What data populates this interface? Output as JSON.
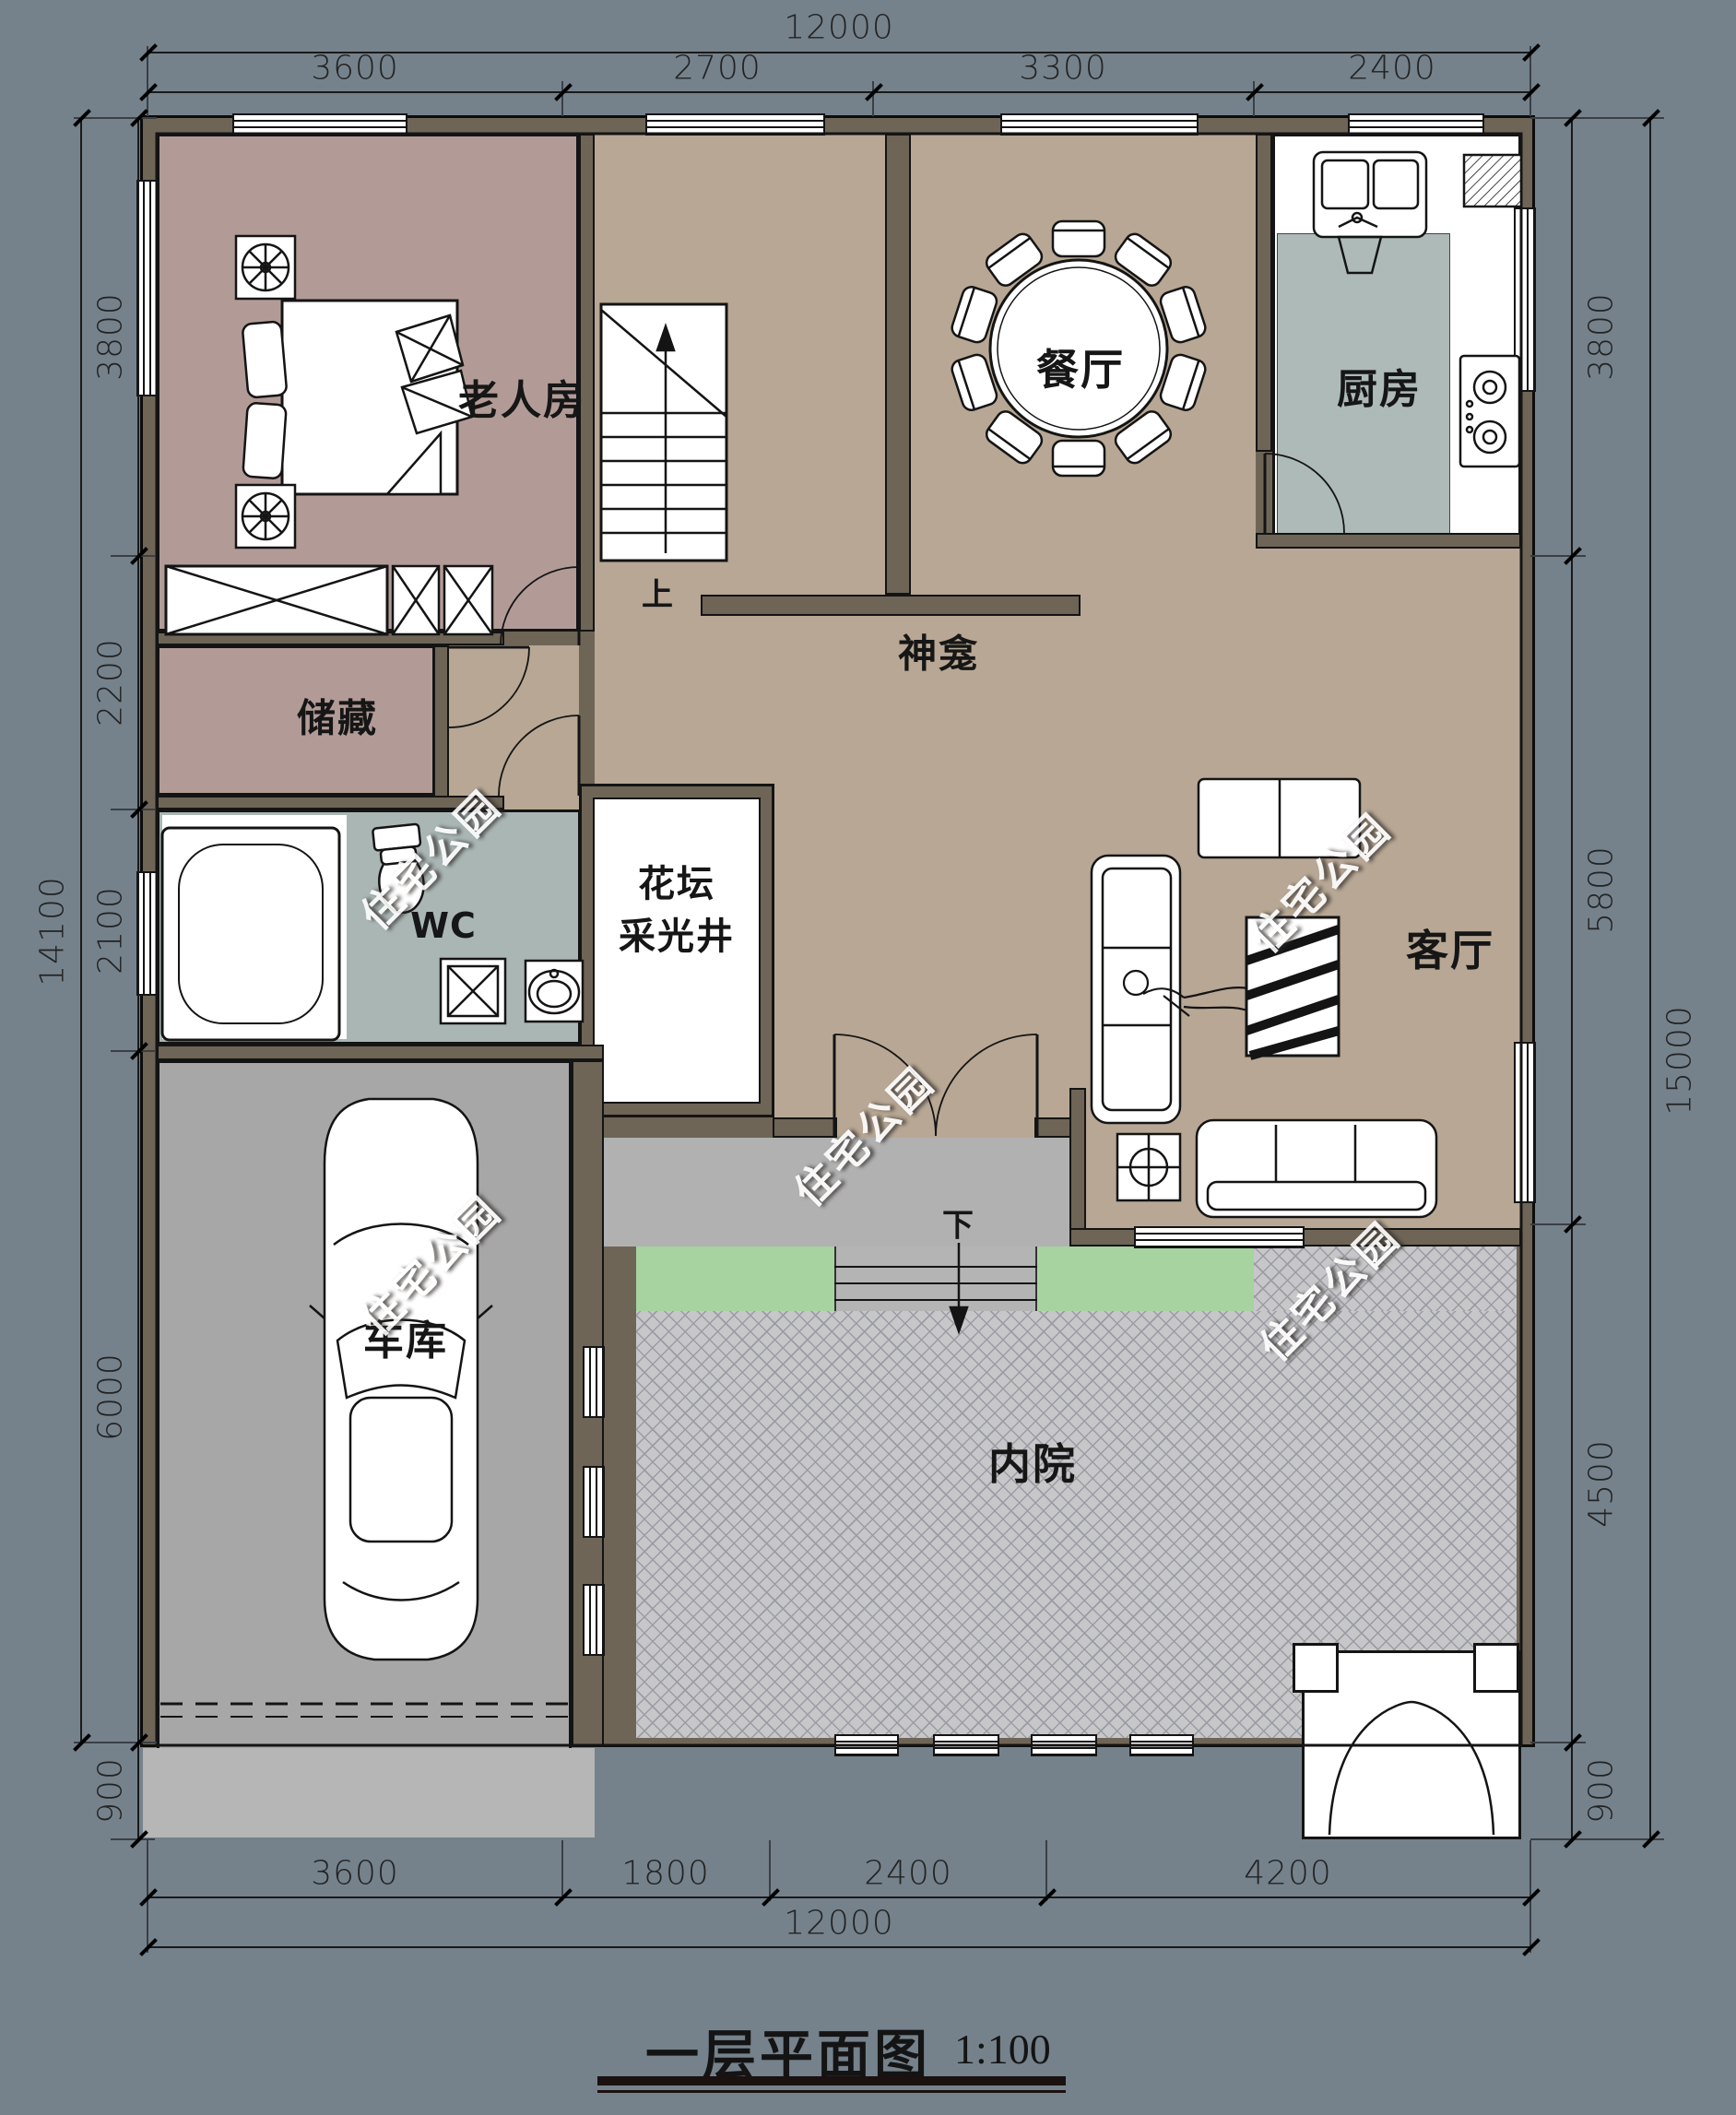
{
  "title": {
    "text": "一层平面图",
    "scale": "1:100"
  },
  "watermark": {
    "text": "住宅公园"
  },
  "rooms": {
    "elder_room": "老人房",
    "dining": "餐厅",
    "kitchen": "厨房",
    "shrine": "神龛",
    "storage": "储藏",
    "wc": "WC",
    "lightwell": [
      "花坛",
      "采光井"
    ],
    "living": "客厅",
    "garage": "车库",
    "courtyard": "内院"
  },
  "annotations": {
    "stairs_up": "上",
    "steps_down": "下"
  },
  "dimensions": {
    "top": {
      "total": "12000",
      "segments": [
        "3600",
        "2700",
        "3300",
        "2400"
      ]
    },
    "bottom": {
      "total": "12000",
      "segments": [
        "3600",
        "1800",
        "2400",
        "4200"
      ]
    },
    "left": {
      "total": "14100",
      "segments": [
        "3800",
        "2200",
        "2100",
        "6000",
        "900"
      ]
    },
    "right": {
      "total": "15000",
      "segments": [
        "3800",
        "5800",
        "4500",
        "900"
      ]
    }
  },
  "colors": {
    "background": "#75828C",
    "wall_fill": "#6E6557",
    "wall_line": "#141414",
    "floor_hall": "#B7A794",
    "floor_bedroom": "#B29B97",
    "floor_wet": "#A9B6B4",
    "floor_garage": "#A7A7A7",
    "floor_porch": "#B1B1B1",
    "courtyard_paving": "#C7C7CA",
    "garden_green": "#A6D3A0",
    "fixture_white": "#FFFFFF"
  }
}
